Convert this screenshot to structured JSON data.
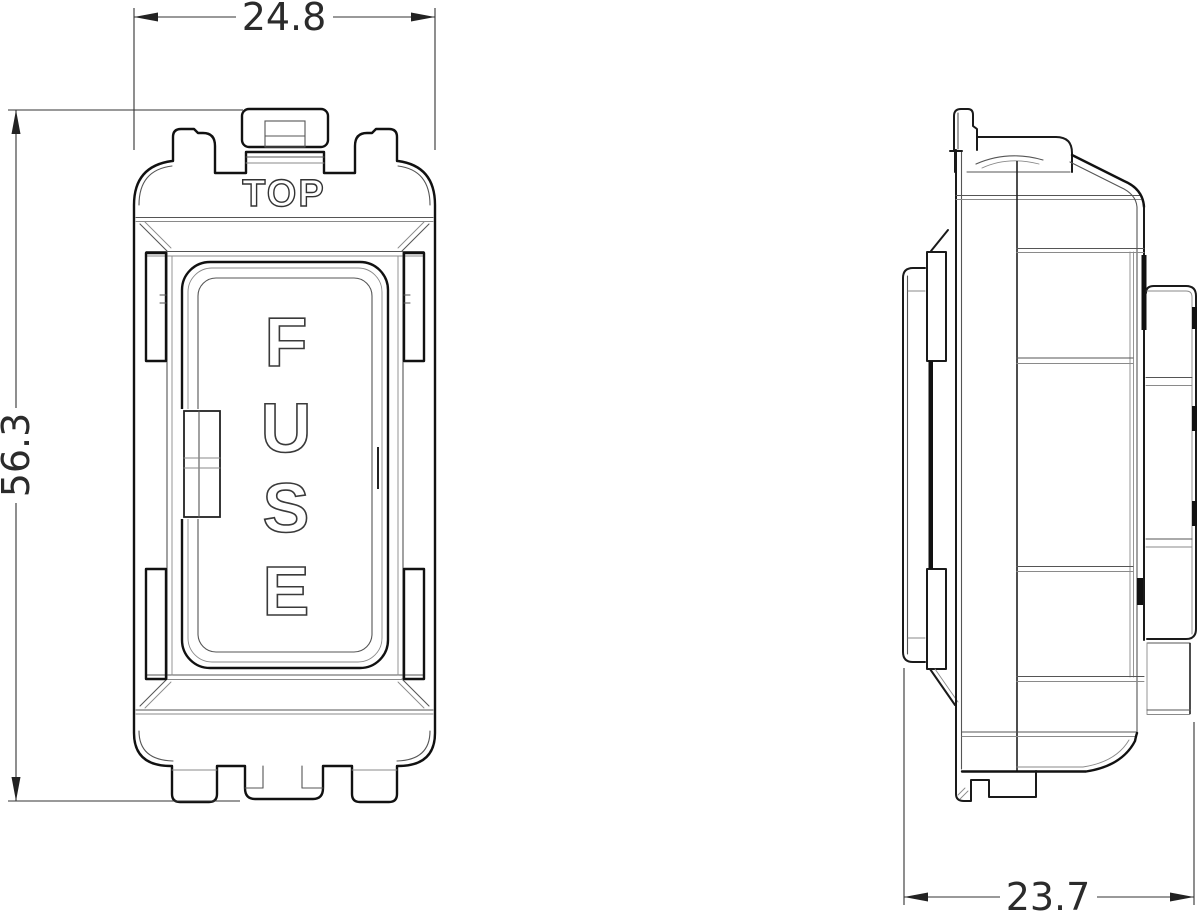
{
  "drawing": {
    "type": "two-view engineering drawing of a grid fuse module",
    "front_view": {
      "label": "front view",
      "top_marking": "TOP",
      "fuse_label": "FUSE",
      "fuse_letters": [
        "F",
        "U",
        "S",
        "E"
      ]
    },
    "side_view": {
      "label": "side view"
    },
    "dimensions": {
      "width": {
        "value": "24.8",
        "view": "front",
        "orientation": "horizontal",
        "position": "top"
      },
      "height": {
        "value": "56.3",
        "view": "front",
        "orientation": "vertical",
        "position": "left"
      },
      "depth": {
        "value": "23.7",
        "view": "side",
        "orientation": "horizontal",
        "position": "bottom"
      }
    },
    "colors": {
      "background": "#ffffff",
      "main_line": "#111111",
      "thin_line": "#555555",
      "dimension_line": "#333333",
      "dimension_text": "#2b2b2b"
    }
  }
}
